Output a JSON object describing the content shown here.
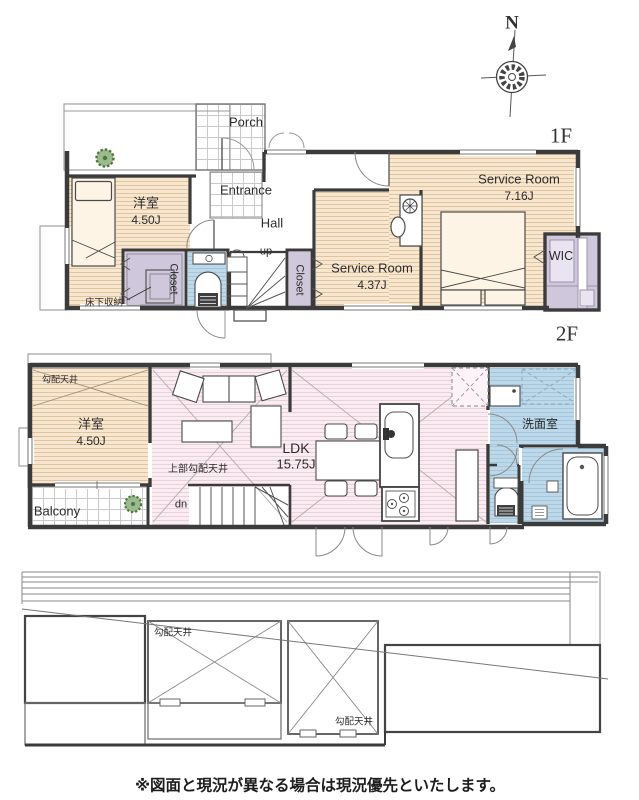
{
  "compass": {
    "north_label": "N"
  },
  "floor1": {
    "floor_label": "1F",
    "porch": "Porch",
    "entrance": "Entrance",
    "hall": "Hall",
    "stairs_up": "up",
    "western_room_name": "洋室",
    "western_room_size": "4.50J",
    "service_room_large_name": "Service Room",
    "service_room_large_size": "7.16J",
    "service_room_small_name": "Service Room",
    "service_room_small_size": "4.37J",
    "wic": "WIC",
    "closet_left": "Closet",
    "closet_right": "Closet",
    "underfloor_storage": "床下収納"
  },
  "floor2": {
    "floor_label": "2F",
    "sloped_ceiling": "勾配天井",
    "western_room_name": "洋室",
    "western_room_size": "4.50J",
    "ldk_name": "LDK",
    "ldk_size": "15.75J",
    "upper_sloped_ceiling": "上部勾配天井",
    "washroom": "洗面室",
    "stairs_down": "dn",
    "balcony": "Balcony"
  },
  "roof": {
    "sloped_ceiling_left": "勾配天井",
    "sloped_ceiling_right": "勾配天井"
  },
  "footer": {
    "disclaimer": "※図面と現況が異なる場合は現況優先といたします。"
  },
  "colors": {
    "wall": "#3b3b3b",
    "room_beige": "#f8e7d0",
    "room_pink": "#f9edf2",
    "wet_blue": "#bdd8e9",
    "closet_purple": "#cfc8dc",
    "tree_green": "#4a7a3a"
  }
}
